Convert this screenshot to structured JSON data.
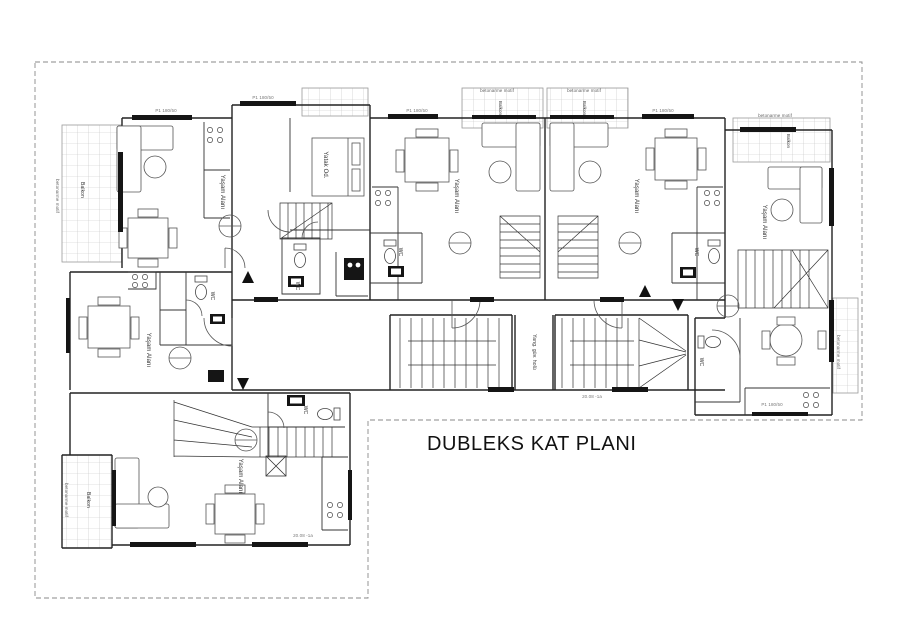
{
  "title": "DUBLEKS KAT PLANI",
  "colors": {
    "wall": "#222222",
    "partition": "#333333",
    "tile_grid": "#c2c2c2",
    "boundary_dash": "#8a8a8a",
    "window_fill": "#151515",
    "label": "#333333",
    "tag": "#777777"
  },
  "labels": [
    {
      "name": "room-label-living-unit1",
      "text": "Yaşam Alanı",
      "x": 222,
      "y": 192,
      "rot": 90,
      "size": 6
    },
    {
      "name": "room-label-living-unit3",
      "text": "Yaşam Alanı",
      "x": 456,
      "y": 196,
      "rot": 90,
      "size": 6
    },
    {
      "name": "room-label-living-unit4",
      "text": "Yaşam Alanı",
      "x": 636,
      "y": 196,
      "rot": 90,
      "size": 6
    },
    {
      "name": "room-label-living-unit5",
      "text": "Yaşam Alanı",
      "x": 764,
      "y": 222,
      "rot": 90,
      "size": 6
    },
    {
      "name": "room-label-living-leftmid",
      "text": "Yaşam Alanı",
      "x": 148,
      "y": 350,
      "rot": 90,
      "size": 6
    },
    {
      "name": "room-label-living-bottom",
      "text": "Yaşam Alanı",
      "x": 240,
      "y": 476,
      "rot": 90,
      "size": 6
    },
    {
      "name": "room-label-bedroom",
      "text": "Yatak Od.",
      "x": 325,
      "y": 165,
      "rot": 90,
      "size": 6
    },
    {
      "name": "room-label-wc-unit2",
      "text": "WC",
      "x": 297,
      "y": 286,
      "rot": 90,
      "size": 5
    },
    {
      "name": "room-label-wc-unit3",
      "text": "WC",
      "x": 400,
      "y": 252,
      "rot": 90,
      "size": 5
    },
    {
      "name": "room-label-wc-unit4",
      "text": "WC",
      "x": 696,
      "y": 252,
      "rot": 90,
      "size": 5
    },
    {
      "name": "room-label-wc-leftmid",
      "text": "WC",
      "x": 212,
      "y": 296,
      "rot": 90,
      "size": 5
    },
    {
      "name": "room-label-wc-bottom",
      "text": "WC",
      "x": 305,
      "y": 410,
      "rot": 90,
      "size": 5
    },
    {
      "name": "room-label-wc-unit5",
      "text": "WC",
      "x": 701,
      "y": 362,
      "rot": 90,
      "size": 5
    },
    {
      "name": "room-label-balcony-left",
      "text": "Balkon",
      "x": 82,
      "y": 190,
      "rot": 90,
      "size": 5
    },
    {
      "name": "room-label-balcony-bottomleft",
      "text": "Balkon",
      "x": 88,
      "y": 500,
      "rot": 90,
      "size": 5
    },
    {
      "name": "room-label-balcony-top1",
      "text": "Balkon",
      "x": 500,
      "y": 108,
      "rot": 90,
      "size": 4.5
    },
    {
      "name": "room-label-balcony-top2",
      "text": "Balkon",
      "x": 584,
      "y": 108,
      "rot": 90,
      "size": 4.5
    },
    {
      "name": "room-label-balcony-right",
      "text": "Balkon",
      "x": 788,
      "y": 141,
      "rot": 90,
      "size": 4.5
    },
    {
      "name": "note-betonarme-top1",
      "text": "betonarme motif",
      "x": 497,
      "y": 91,
      "rot": 0,
      "size": 4.5,
      "color": "#666666"
    },
    {
      "name": "note-betonarme-top2",
      "text": "betonarme motif",
      "x": 584,
      "y": 91,
      "rot": 0,
      "size": 4.5,
      "color": "#666666"
    },
    {
      "name": "note-betonarme-left",
      "text": "betonarme motif",
      "x": 57,
      "y": 196,
      "rot": 90,
      "size": 4.5,
      "color": "#666666"
    },
    {
      "name": "note-betonarme-bottomleft",
      "text": "betonarme motif",
      "x": 66,
      "y": 500,
      "rot": 90,
      "size": 4.5,
      "color": "#666666"
    },
    {
      "name": "note-betonarme-topright",
      "text": "betonarme motif",
      "x": 775,
      "y": 116,
      "rot": 0,
      "size": 4.5,
      "color": "#666666"
    },
    {
      "name": "note-betonarme-right",
      "text": "betonarme motif",
      "x": 838,
      "y": 352,
      "rot": 90,
      "size": 4.5,
      "color": "#666666"
    },
    {
      "name": "room-label-fire-hall",
      "text": "Yang. güv. holü",
      "x": 534,
      "y": 352,
      "rot": 90,
      "size": 5
    },
    {
      "name": "window-tag-1",
      "text": "P1  180/50",
      "x": 166,
      "y": 111,
      "rot": 0,
      "size": 4.5,
      "color": "#777777"
    },
    {
      "name": "window-tag-2",
      "text": "P1  180/50",
      "x": 263,
      "y": 98,
      "rot": 0,
      "size": 4.5,
      "color": "#777777"
    },
    {
      "name": "window-tag-3",
      "text": "P1  180/50",
      "x": 417,
      "y": 111,
      "rot": 0,
      "size": 4.5,
      "color": "#777777"
    },
    {
      "name": "window-tag-4",
      "text": "P1  180/50",
      "x": 663,
      "y": 111,
      "rot": 0,
      "size": 4.5,
      "color": "#777777"
    },
    {
      "name": "window-tag-5",
      "text": "P1  180/50",
      "x": 772,
      "y": 405,
      "rot": 0,
      "size": 4.5,
      "color": "#777777"
    },
    {
      "name": "dim-tag-corridor",
      "text": "20.08 -1a",
      "x": 592,
      "y": 397,
      "rot": 0,
      "size": 4.5,
      "color": "#777777"
    },
    {
      "name": "dim-tag-bottom",
      "text": "20.08 -1a",
      "x": 303,
      "y": 536,
      "rot": 0,
      "size": 4.5,
      "color": "#777777"
    }
  ]
}
